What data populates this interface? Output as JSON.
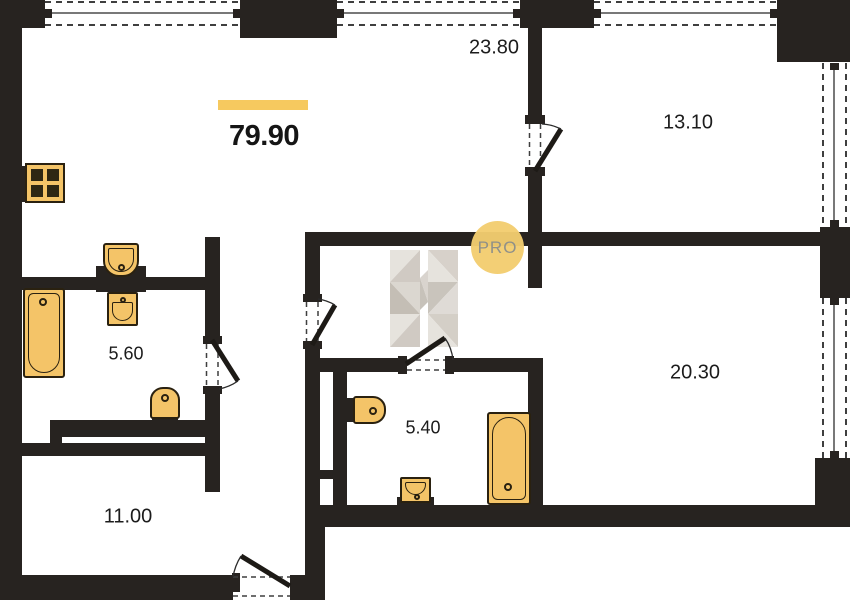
{
  "floorplan": {
    "total_area": "79.90",
    "badge_label": "PRO",
    "rooms": {
      "living": {
        "area": "23.80"
      },
      "bedroom_1": {
        "area": "13.10"
      },
      "bedroom_2": {
        "area": "20.30"
      },
      "bathroom_1": {
        "area": "5.60"
      },
      "bathroom_2": {
        "area": "5.40"
      },
      "entry_hall": {
        "area": "11.00"
      }
    },
    "colors": {
      "wall": "#272320",
      "fixture_fill": "#f4c468",
      "accent_bar": "#f6c95f",
      "badge_bg": "#f2cd6f",
      "badge_text": "#8f9089",
      "watermark": "#d8d3cc"
    }
  }
}
